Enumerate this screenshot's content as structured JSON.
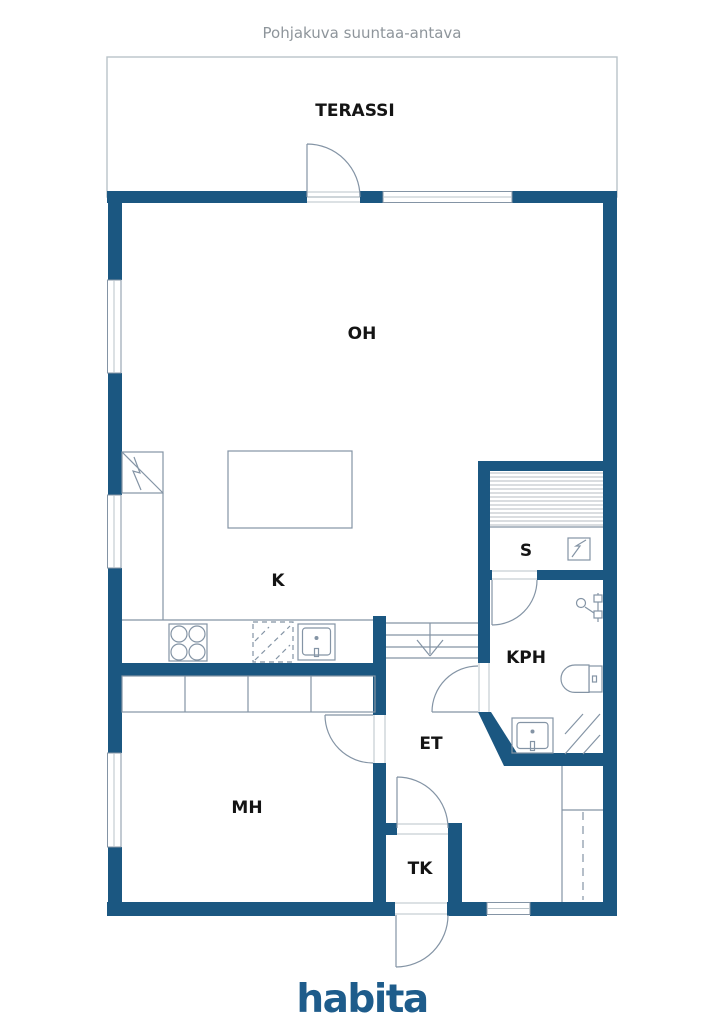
{
  "title": "Pohjakuva suuntaa-antava",
  "footer": {
    "logo_text": "habita"
  },
  "colors": {
    "wall": "#1B5781",
    "line": "#8494A5",
    "light_line": "#B9C3C9",
    "logo": "#1E5C8B",
    "title_text": "#8E959B",
    "label_text": "#141414",
    "sauna_stripe": "#CDD2D6"
  },
  "rooms": [
    {
      "id": "terassi",
      "label": "TERASSI"
    },
    {
      "id": "oh",
      "label": "OH"
    },
    {
      "id": "k",
      "label": "K"
    },
    {
      "id": "s",
      "label": "S"
    },
    {
      "id": "kph",
      "label": "KPH"
    },
    {
      "id": "et",
      "label": "ET"
    },
    {
      "id": "mh",
      "label": "MH"
    },
    {
      "id": "tk",
      "label": "TK"
    }
  ],
  "icons": {
    "fireplace": "fireplace-icon",
    "stove": "stove-icon",
    "dishwasher": "dishwasher-icon",
    "sink": "sink-icon",
    "sauna_stove": "sauna-stove-icon",
    "shower": "shower-icon",
    "toilet": "toilet-icon",
    "water_heater": "water-heater-icon",
    "stairs": "stairs-down-arrow-icon",
    "closet_rail": "closet-rail-icon"
  }
}
